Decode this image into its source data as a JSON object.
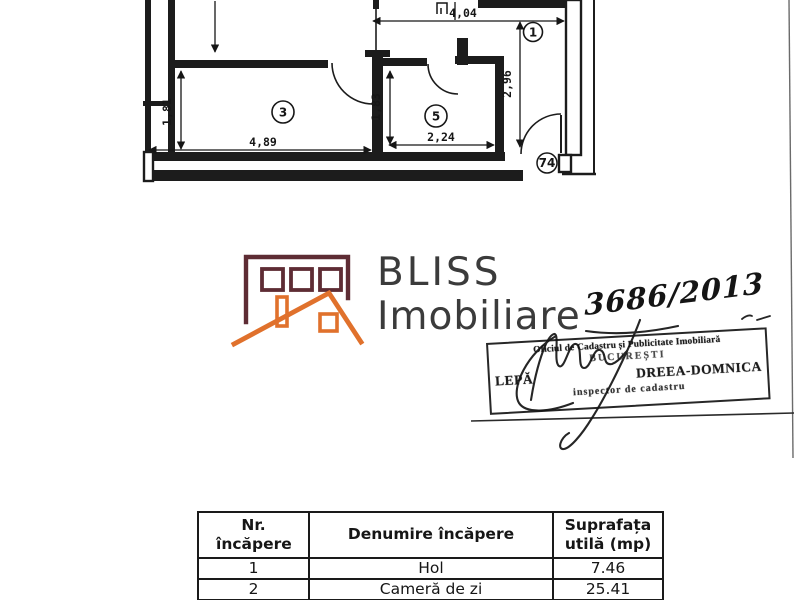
{
  "document": {
    "floor_plan": {
      "dimensions": {
        "top_width": "4,04",
        "hall_height": "2,96",
        "room3_height": "1,81",
        "room3_width": "4,89",
        "room5_height": "1,83",
        "room5_width": "2,24"
      },
      "labels": {
        "room1": "1",
        "room3": "3",
        "room5": "5",
        "entrance": "74"
      }
    },
    "logo": {
      "title": "BLISS",
      "subtitle": "Imobiliare"
    },
    "annotation": {
      "registration_number": "3686/2013"
    },
    "stamp": {
      "office": "Oficiul de Cadastru și Publicitate Imobiliară",
      "city": "BUCUREȘTI",
      "inspector_name_start": "LEPĂ",
      "inspector_name_end": "DREEA-DOMNICA",
      "title": "inspector de cadastru"
    },
    "room_table": {
      "headers": {
        "number": "Nr. încăpere",
        "name": "Denumire încăpere",
        "area": "Suprafața utilă (mp)"
      },
      "rows": [
        {
          "number": "1",
          "name": "Hol",
          "area": "7.46"
        },
        {
          "number": "2",
          "name": "Cameră de zi",
          "area": "25.41"
        }
      ]
    },
    "colors": {
      "brand_maroon": "#5e2c34",
      "brand_orange": "#e0712c",
      "logo_text": "#3b3b3b",
      "ink": "#1a1a1a"
    }
  }
}
